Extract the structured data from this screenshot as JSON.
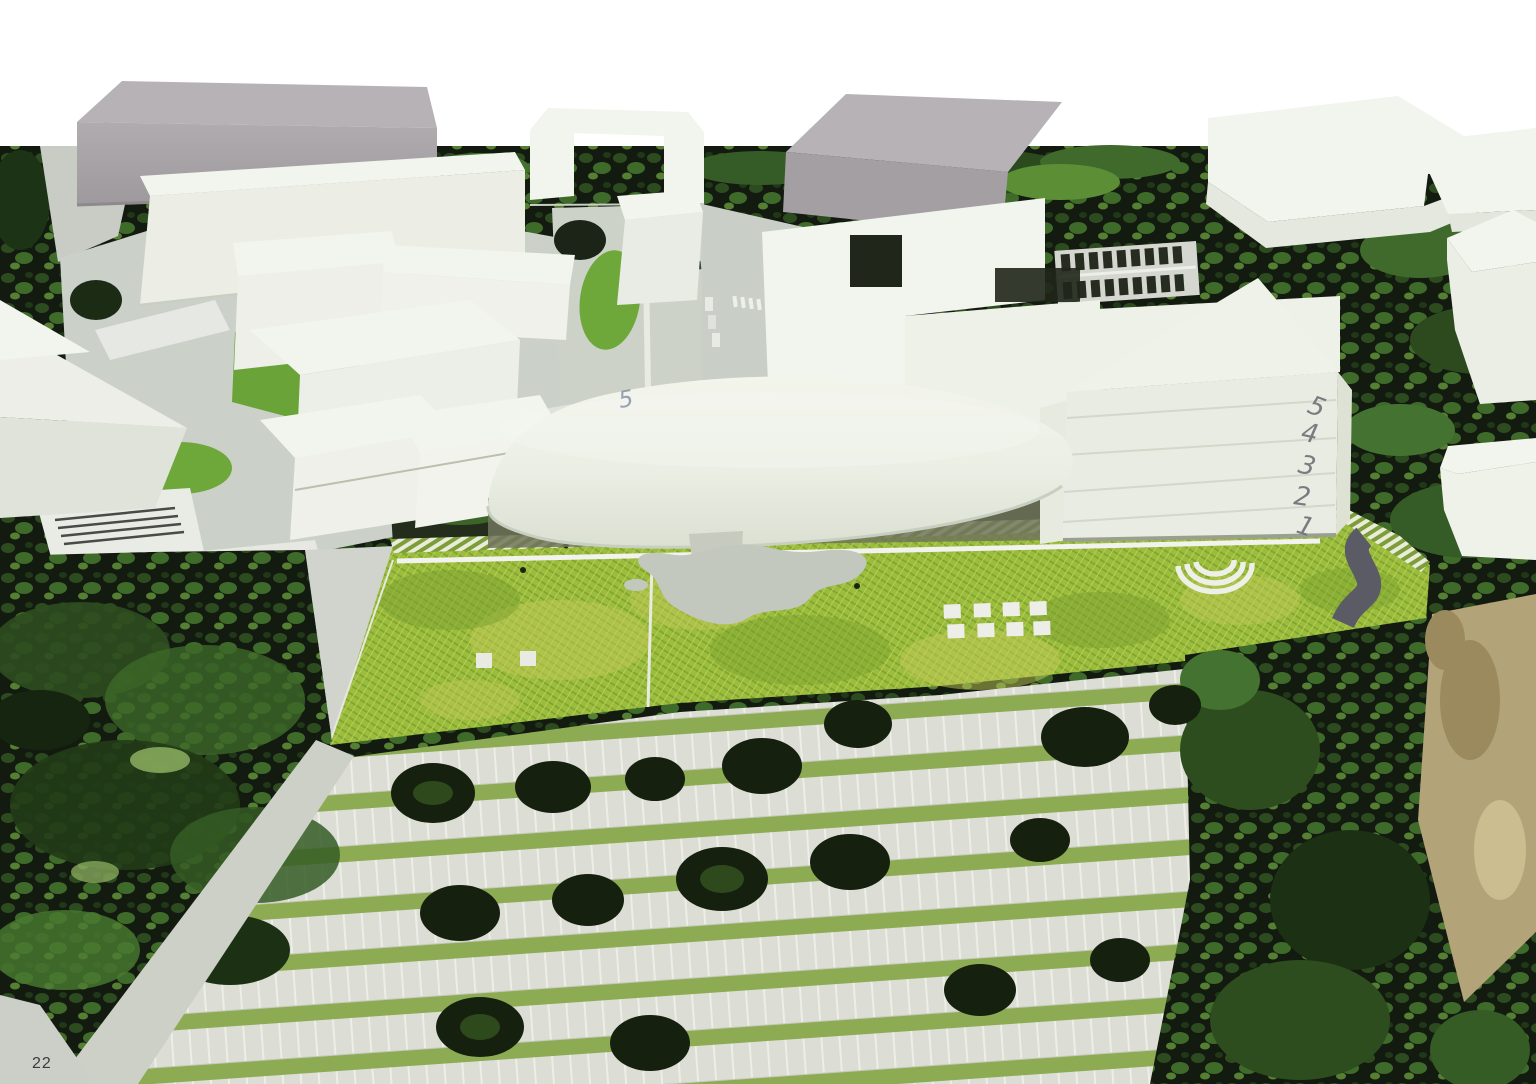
{
  "page": {
    "number": "22"
  },
  "annotations": {
    "floor_numbers": [
      "5",
      "4",
      "3",
      "2",
      "1"
    ],
    "plan_mark": "5"
  },
  "colors": {
    "sky": "#ffffff",
    "map_dark": "#131a10",
    "lawn_green": "#9abd3d",
    "parking_light": "#dcddd5",
    "plaza_light": "#cbd0c9",
    "foam_white": "#f2f4ee",
    "gray_top": "#b6b2b5",
    "gray_front": "#a39fa3",
    "plinth": "#c7cbbf",
    "blob_plaza": "#c3c8bf",
    "curve_road": "#5b5b66",
    "amphitheater": "#eef0e8",
    "shadow_band": "#70755a",
    "brown_path": "#b3a379",
    "pencil": "#6f6f76",
    "plan_mark_blue": "#7e8aa4",
    "page_number": "#3b3b3b"
  }
}
